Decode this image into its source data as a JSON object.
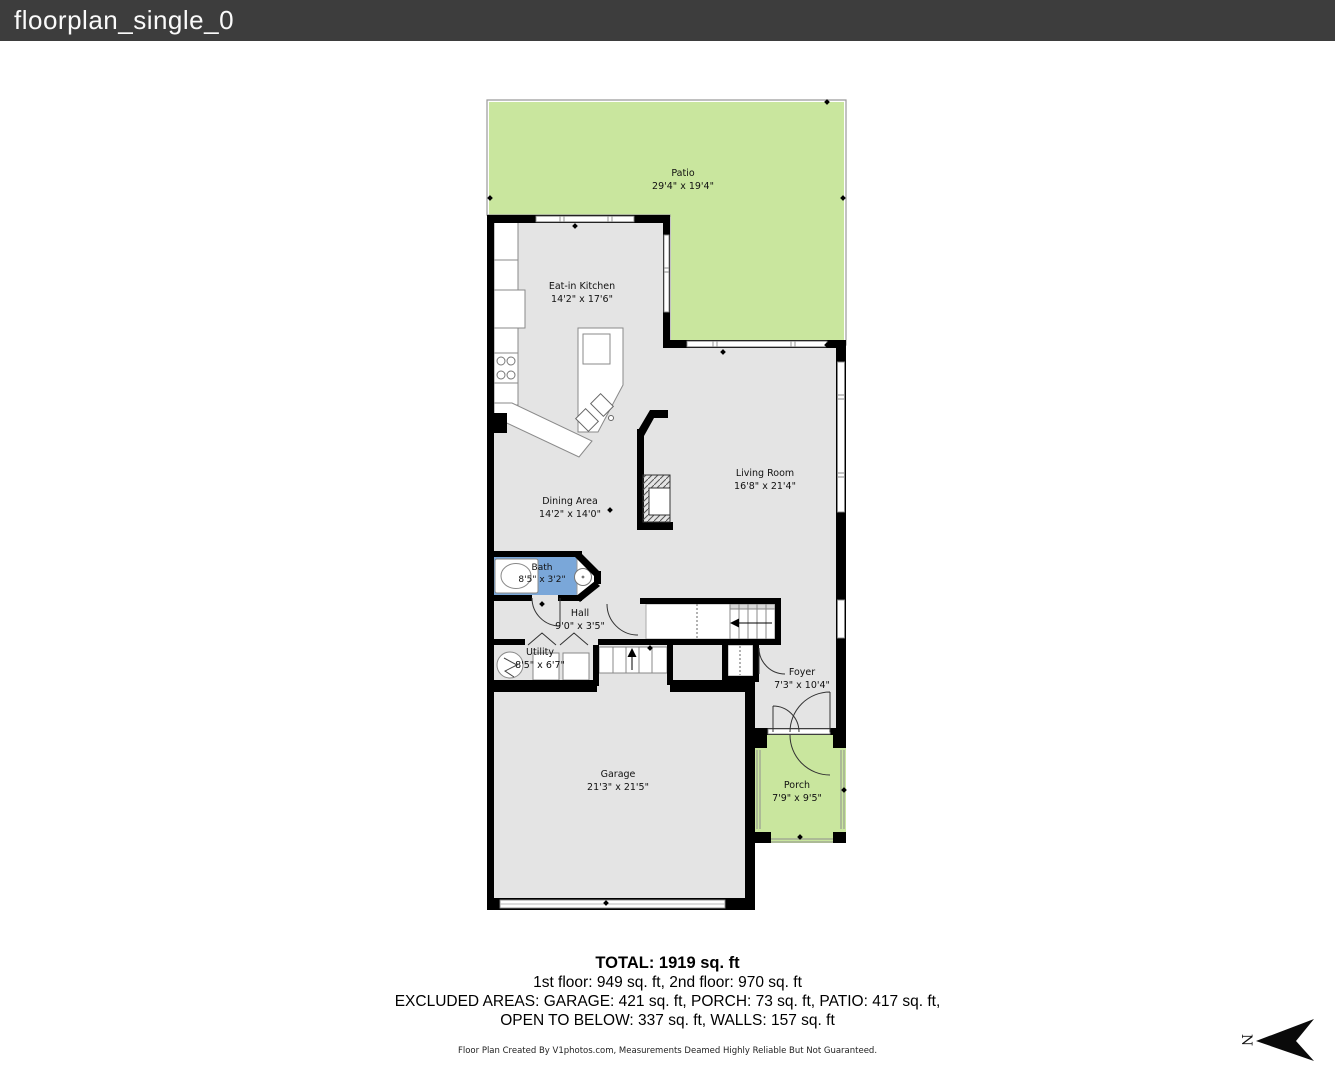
{
  "header": {
    "title": "floorplan_single_0"
  },
  "rooms": [
    {
      "id": "patio",
      "name": "Patio",
      "dims": "29'4\" x 19'4\""
    },
    {
      "id": "kitchen",
      "name": "Eat-in Kitchen",
      "dims": "14'2\" x 17'6\""
    },
    {
      "id": "living",
      "name": "Living Room",
      "dims": "16'8\" x 21'4\""
    },
    {
      "id": "dining",
      "name": "Dining Area",
      "dims": "14'2\" x 14'0\""
    },
    {
      "id": "bath",
      "name": "Bath",
      "dims": "8'5\" x 3'2\""
    },
    {
      "id": "hall",
      "name": "Hall",
      "dims": "9'0\" x 3'5\""
    },
    {
      "id": "utility",
      "name": "Utility",
      "dims": "8'5\" x 6'7\""
    },
    {
      "id": "foyer",
      "name": "Foyer",
      "dims": "7'3\" x 10'4\""
    },
    {
      "id": "garage",
      "name": "Garage",
      "dims": "21'3\" x 21'5\""
    },
    {
      "id": "porch",
      "name": "Porch",
      "dims": "7'9\" x 9'5\""
    }
  ],
  "summary": {
    "total": "TOTAL: 1919 sq. ft",
    "floors": "1st floor: 949 sq. ft, 2nd floor: 970 sq. ft",
    "excluded_line1": "EXCLUDED AREAS: GARAGE: 421 sq. ft, PORCH: 73 sq. ft, PATIO: 417 sq. ft,",
    "excluded_line2": "OPEN TO BELOW: 337 sq. ft, WALLS: 157 sq. ft"
  },
  "credit": "Floor Plan Created By V1photos.com, Measurements Deamed Highly Reliable But Not Guaranteed.",
  "compass": {
    "letter": "N"
  },
  "colors": {
    "patio_green": "#c9e69e",
    "floor_gray": "#e4e4e4",
    "bath_blue": "#7aa7d9",
    "wall": "#000000"
  }
}
